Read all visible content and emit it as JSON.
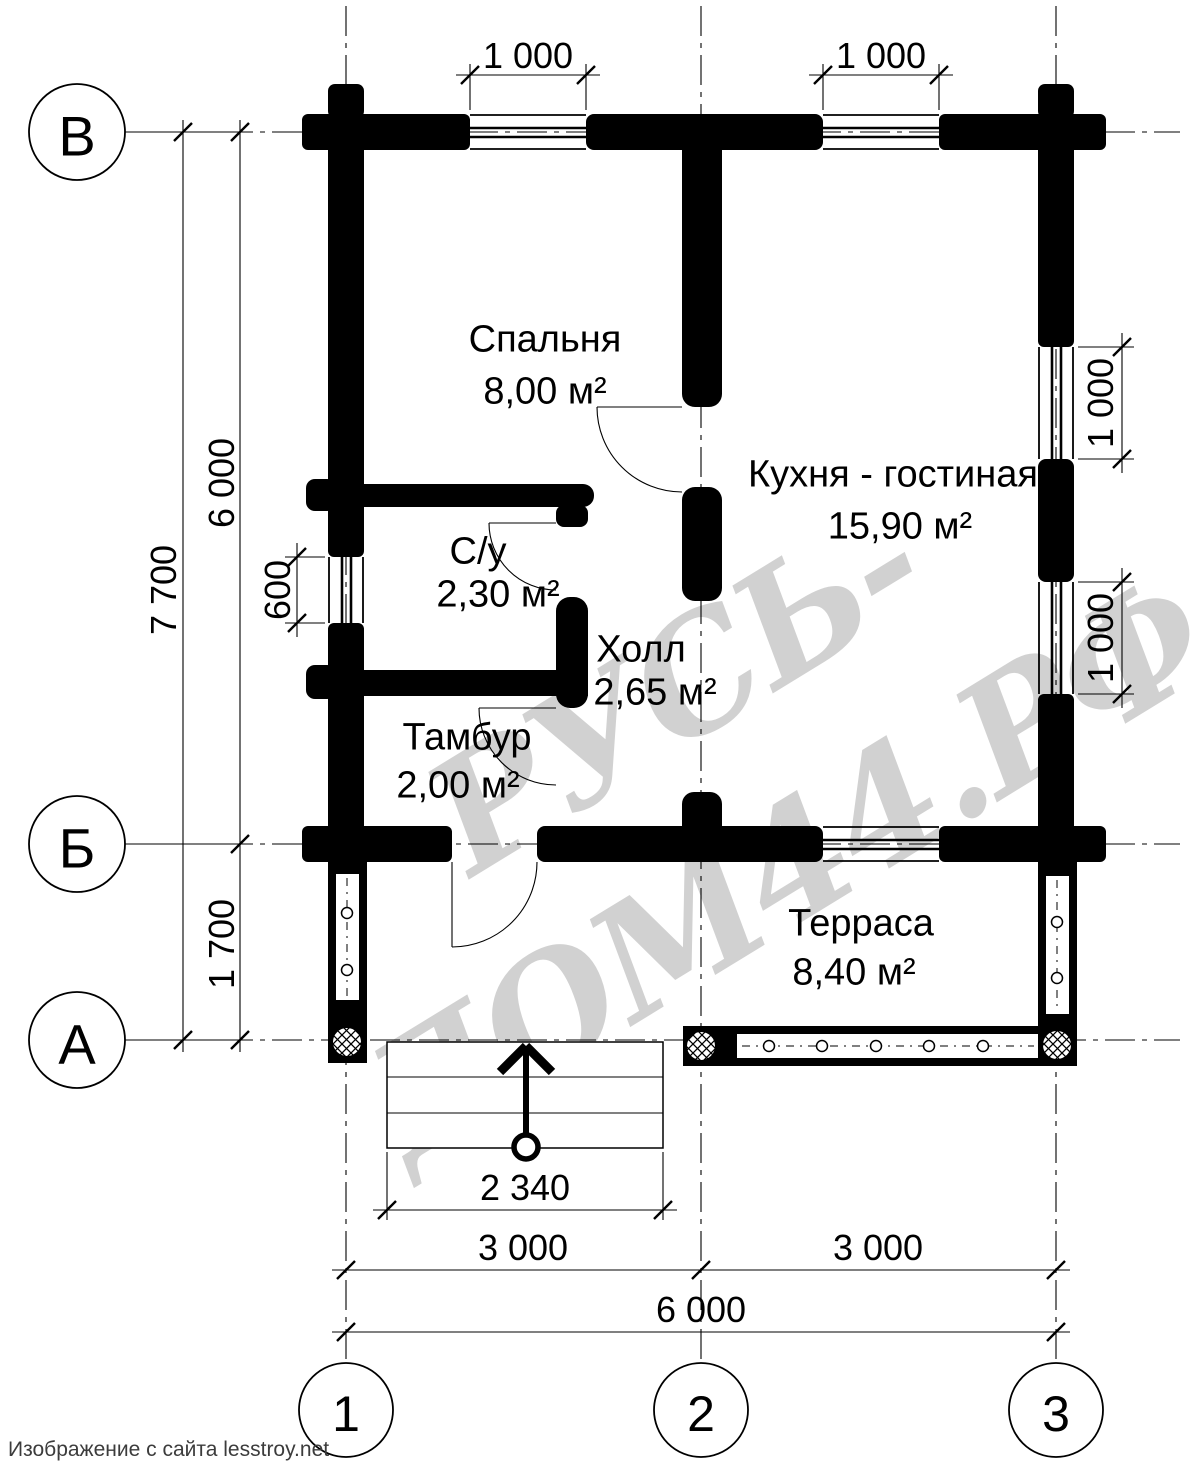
{
  "watermark": "РУСЬ-ДОМ44.РФ",
  "footer": "Изображение с сайта lesstroy.net",
  "axes": {
    "rows": [
      {
        "label": "В"
      },
      {
        "label": "Б"
      },
      {
        "label": "А"
      }
    ],
    "cols": [
      {
        "label": "1"
      },
      {
        "label": "2"
      },
      {
        "label": "3"
      }
    ]
  },
  "rooms": [
    {
      "name": "Спальня",
      "area": "8,00 м²"
    },
    {
      "name": "Кухня - гостиная",
      "area": "15,90 м²"
    },
    {
      "name": "С/у",
      "area": "2,30 м²"
    },
    {
      "name": "Холл",
      "area": "2,65 м²"
    },
    {
      "name": "Тамбур",
      "area": "2,00 м²"
    },
    {
      "name": "Терраса",
      "area": "8,40 м²"
    }
  ],
  "dimensions": {
    "top_window_left": "1 000",
    "top_window_right": "1 000",
    "left_total": "7 700",
    "left_main": "6 000",
    "left_terrace": "1 700",
    "left_window": "600",
    "right_window_upper": "1 000",
    "right_window_lower": "1 000",
    "stairs_width": "2 340",
    "span_1_2": "3 000",
    "span_2_3": "3 000",
    "total_width": "6 000"
  }
}
